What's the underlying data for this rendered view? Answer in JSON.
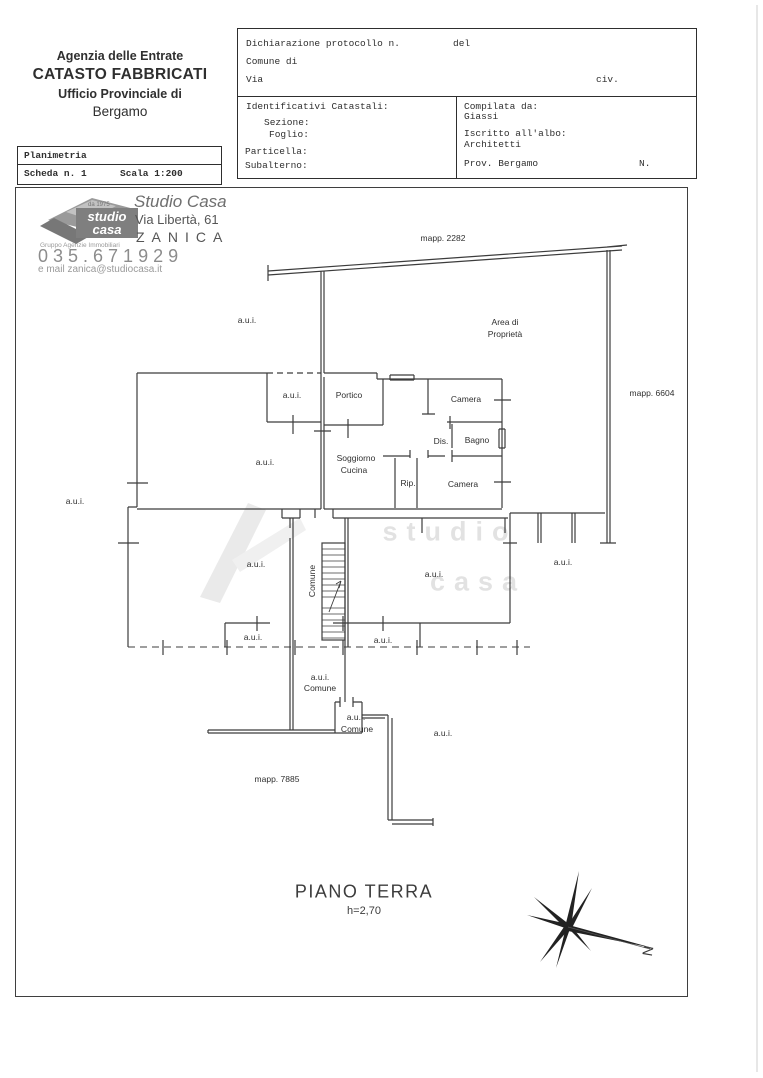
{
  "header": {
    "left": {
      "line1": "Agenzia delle Entrate",
      "line2": "CATASTO FABBRICATI",
      "line3": "Ufficio Provinciale di",
      "line4": "Bergamo"
    },
    "form": {
      "protocol_label": "Dichiarazione protocollo n.",
      "del_label": "del",
      "comune_label": "Comune di",
      "via_label": "Via",
      "civ_label": "civ.",
      "catastali_title": "Identificativi Catastali:",
      "sezione": "Sezione:",
      "foglio": "Foglio:",
      "particella": "Particella:",
      "subalterno": "Subalterno:",
      "compilata_label": "Compilata da:",
      "compilata_value": "Giassi",
      "albo_label": "Iscritto all'albo:",
      "albo_value": "Architetti",
      "prov_label": "Prov. Bergamo",
      "n_label": "N."
    },
    "plan_table": {
      "title": "Planimetria",
      "scheda": "Scheda n. 1",
      "scala": "Scala 1:200"
    }
  },
  "agency": {
    "name": "Studio Casa",
    "address": "Via Libertà, 61",
    "city": "ZANICA",
    "phone": "035.671929",
    "email": "e mail zanica@studiocasa.it",
    "logo": {
      "era": "da 1975",
      "word1": "studio",
      "word2": "casa",
      "subtitle": "Gruppo Agenzie Immobiliari"
    }
  },
  "plan": {
    "labels": [
      {
        "text": "a.u.i."
      },
      {
        "text": "Area di"
      },
      {
        "text": "Proprietà"
      },
      {
        "text": "mapp. 2282"
      },
      {
        "text": "mapp. 6604"
      },
      {
        "text": "a.u.i."
      },
      {
        "text": "Portico"
      },
      {
        "text": "Camera"
      },
      {
        "text": "Dis."
      },
      {
        "text": "Bagno"
      },
      {
        "text": "Soggiorno"
      },
      {
        "text": "Cucina"
      },
      {
        "text": "Rip."
      },
      {
        "text": "Camera"
      },
      {
        "text": "a.u.i."
      },
      {
        "text": "a.u.i."
      },
      {
        "text": "a.u.i."
      },
      {
        "text": "Comune"
      },
      {
        "text": "a.u.i."
      },
      {
        "text": "a.u.i."
      },
      {
        "text": "a.u.i."
      },
      {
        "text": "a.u.i."
      },
      {
        "text": "a.u.i."
      },
      {
        "text": "Comune"
      },
      {
        "text": "a.u.i."
      },
      {
        "text": "Comune"
      },
      {
        "text": "a.u.i."
      },
      {
        "text": "mapp. 7885"
      }
    ],
    "title": "PIANO TERRA",
    "height_note": "h=2,70",
    "compass_n": "N",
    "watermark": {
      "word1": "studio",
      "word2": "casa"
    }
  }
}
